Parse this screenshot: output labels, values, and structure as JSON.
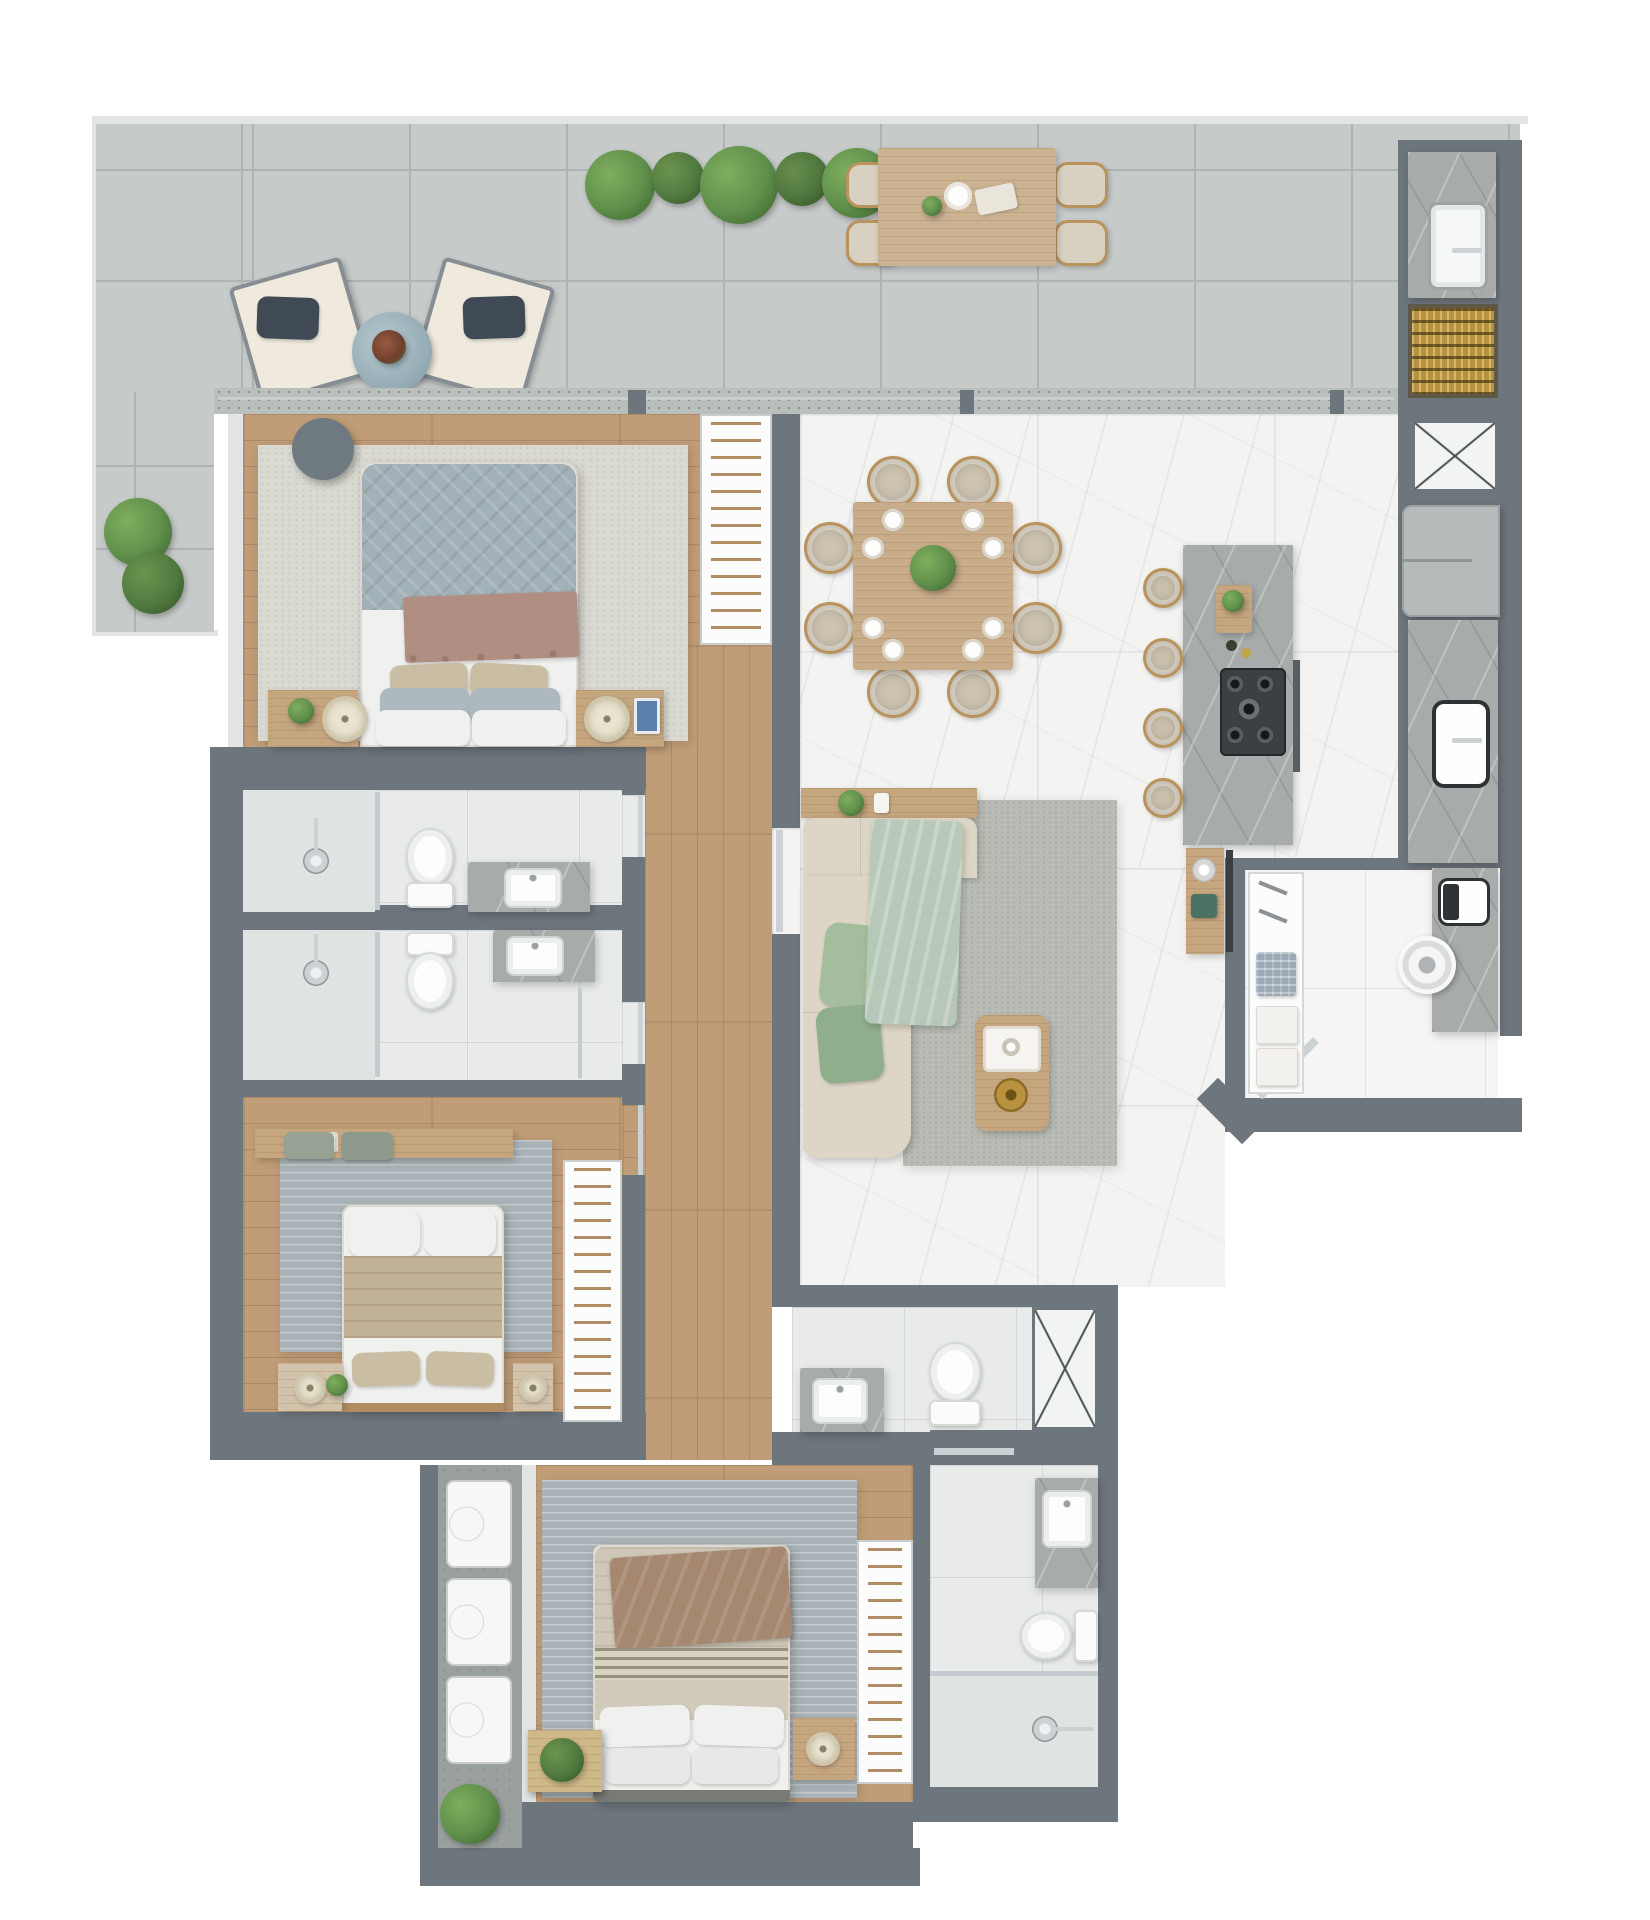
{
  "meta": {
    "type": "3d-floor-plan-render",
    "view": "top-down",
    "visible_text": "none"
  },
  "palette": {
    "wall": "#6d757d",
    "wallLight": "#e2e5e4",
    "ductLine": "#4a5054",
    "terrace": "#c6cac9",
    "terraceLine": "#aeb4b3",
    "sill": "#b9bfbb",
    "wood": "#c09d77",
    "woodDark": "#b08c63",
    "woodFurn": "#c6a67f",
    "marble": "#f3f3f1",
    "island": "#a7abaa",
    "bath": "#e9ebea",
    "showerFloor": "#dfe3e2",
    "laundryFloor": "#f4f5f4",
    "concrete": "#9aa09e",
    "rugLight": "#dadad3",
    "rugBlue": "#a9b2b6",
    "rugLiving": "#b9bcb4",
    "quilt": "#a2b0b8",
    "quiltDark": "#aeb9bf",
    "throwMauve": "#b08e82",
    "linen": "#f0f1ef",
    "beigePillow": "#c9bda3",
    "tanBlanket": "#c2b298",
    "brownThrow": "#a5886f",
    "sofa": "#ddd5c5",
    "sage": "#a3bd9d",
    "sageDark": "#8fae8b",
    "sageLight": "#b7c9ba",
    "chairBeige": "#ccc3b1",
    "rattan": "#b9925c",
    "gold": "#b8923f",
    "cooktop": "#3c4043",
    "chrome": "#ccd1d4",
    "steel": "#9da4a8",
    "plant": "#5f8f4b",
    "plantDark": "#3e692f",
    "cream": "#e9e3cf",
    "bookBlue": "#5b7fae",
    "tealDecor": "#4c7263",
    "applianceGray": "#b6baba",
    "glassline": "#c5cccf",
    "white": "#fbfbfa"
  },
  "rooms": [
    {
      "id": "terrace",
      "label": "terrace-balcony",
      "floor": "concrete-tile",
      "items": [
        "lounge-chair",
        "lounge-chair",
        "round-side-table",
        "planter-row",
        "outdoor-dining-table",
        "outdoor-chairs-4",
        "outdoor-sink",
        "barbecue-grill",
        "air-duct",
        "floor-plants"
      ]
    },
    {
      "id": "master-suite",
      "label": "master-bedroom",
      "floor": "wood",
      "items": [
        "double-bed",
        "area-rug",
        "round-side-table",
        "nightstand-left",
        "nightstand-right",
        "table-lamps",
        "wardrobe"
      ]
    },
    {
      "id": "bathroom-1",
      "label": "ensuite-bathroom",
      "floor": "tile",
      "items": [
        "shower",
        "toilet",
        "vanity-sink"
      ]
    },
    {
      "id": "bathroom-2",
      "label": "bathroom",
      "floor": "tile",
      "items": [
        "shower",
        "toilet",
        "vanity-sink"
      ]
    },
    {
      "id": "bedroom-2",
      "label": "middle-bedroom",
      "floor": "wood",
      "items": [
        "double-bed",
        "area-rug",
        "desk",
        "stools-2",
        "nightstand-left",
        "nightstand-right",
        "wardrobe"
      ]
    },
    {
      "id": "hallway",
      "label": "hallway",
      "floor": "wood",
      "items": [
        "sliding-door"
      ]
    },
    {
      "id": "living-dining-kitchen",
      "label": "open-living-dining-kitchen",
      "floor": "marble",
      "items": [
        "square-dining-table",
        "dining-chairs-8",
        "centerpiece-plant",
        "kitchen-island",
        "bar-stools-4",
        "gas-cooktop",
        "cutting-board",
        "refrigerator",
        "kitchen-sink",
        "sofa",
        "console-table",
        "coffee-table",
        "area-rug",
        "tv-sideboard"
      ]
    },
    {
      "id": "laundry",
      "label": "laundry-service-room",
      "floor": "white-tile",
      "items": [
        "shelving-towels",
        "washing-machine",
        "utility-sink",
        "door"
      ]
    },
    {
      "id": "wc",
      "label": "guest-wc",
      "floor": "tile",
      "items": [
        "vanity-sink",
        "toilet",
        "air-duct"
      ]
    },
    {
      "id": "suite-3",
      "label": "bottom-bedroom",
      "floor": "wood",
      "items": [
        "double-bed",
        "area-rug",
        "side-table",
        "nightstand",
        "wardrobe",
        "monstera-plant"
      ]
    },
    {
      "id": "bathroom-3",
      "label": "bottom-bathroom",
      "floor": "tile",
      "items": [
        "vanity-sink",
        "toilet",
        "shower"
      ]
    },
    {
      "id": "service-strip",
      "label": "technical-balcony",
      "floor": "concrete",
      "items": [
        "ac-unit",
        "ac-unit",
        "ac-unit",
        "floor-plant"
      ]
    }
  ]
}
